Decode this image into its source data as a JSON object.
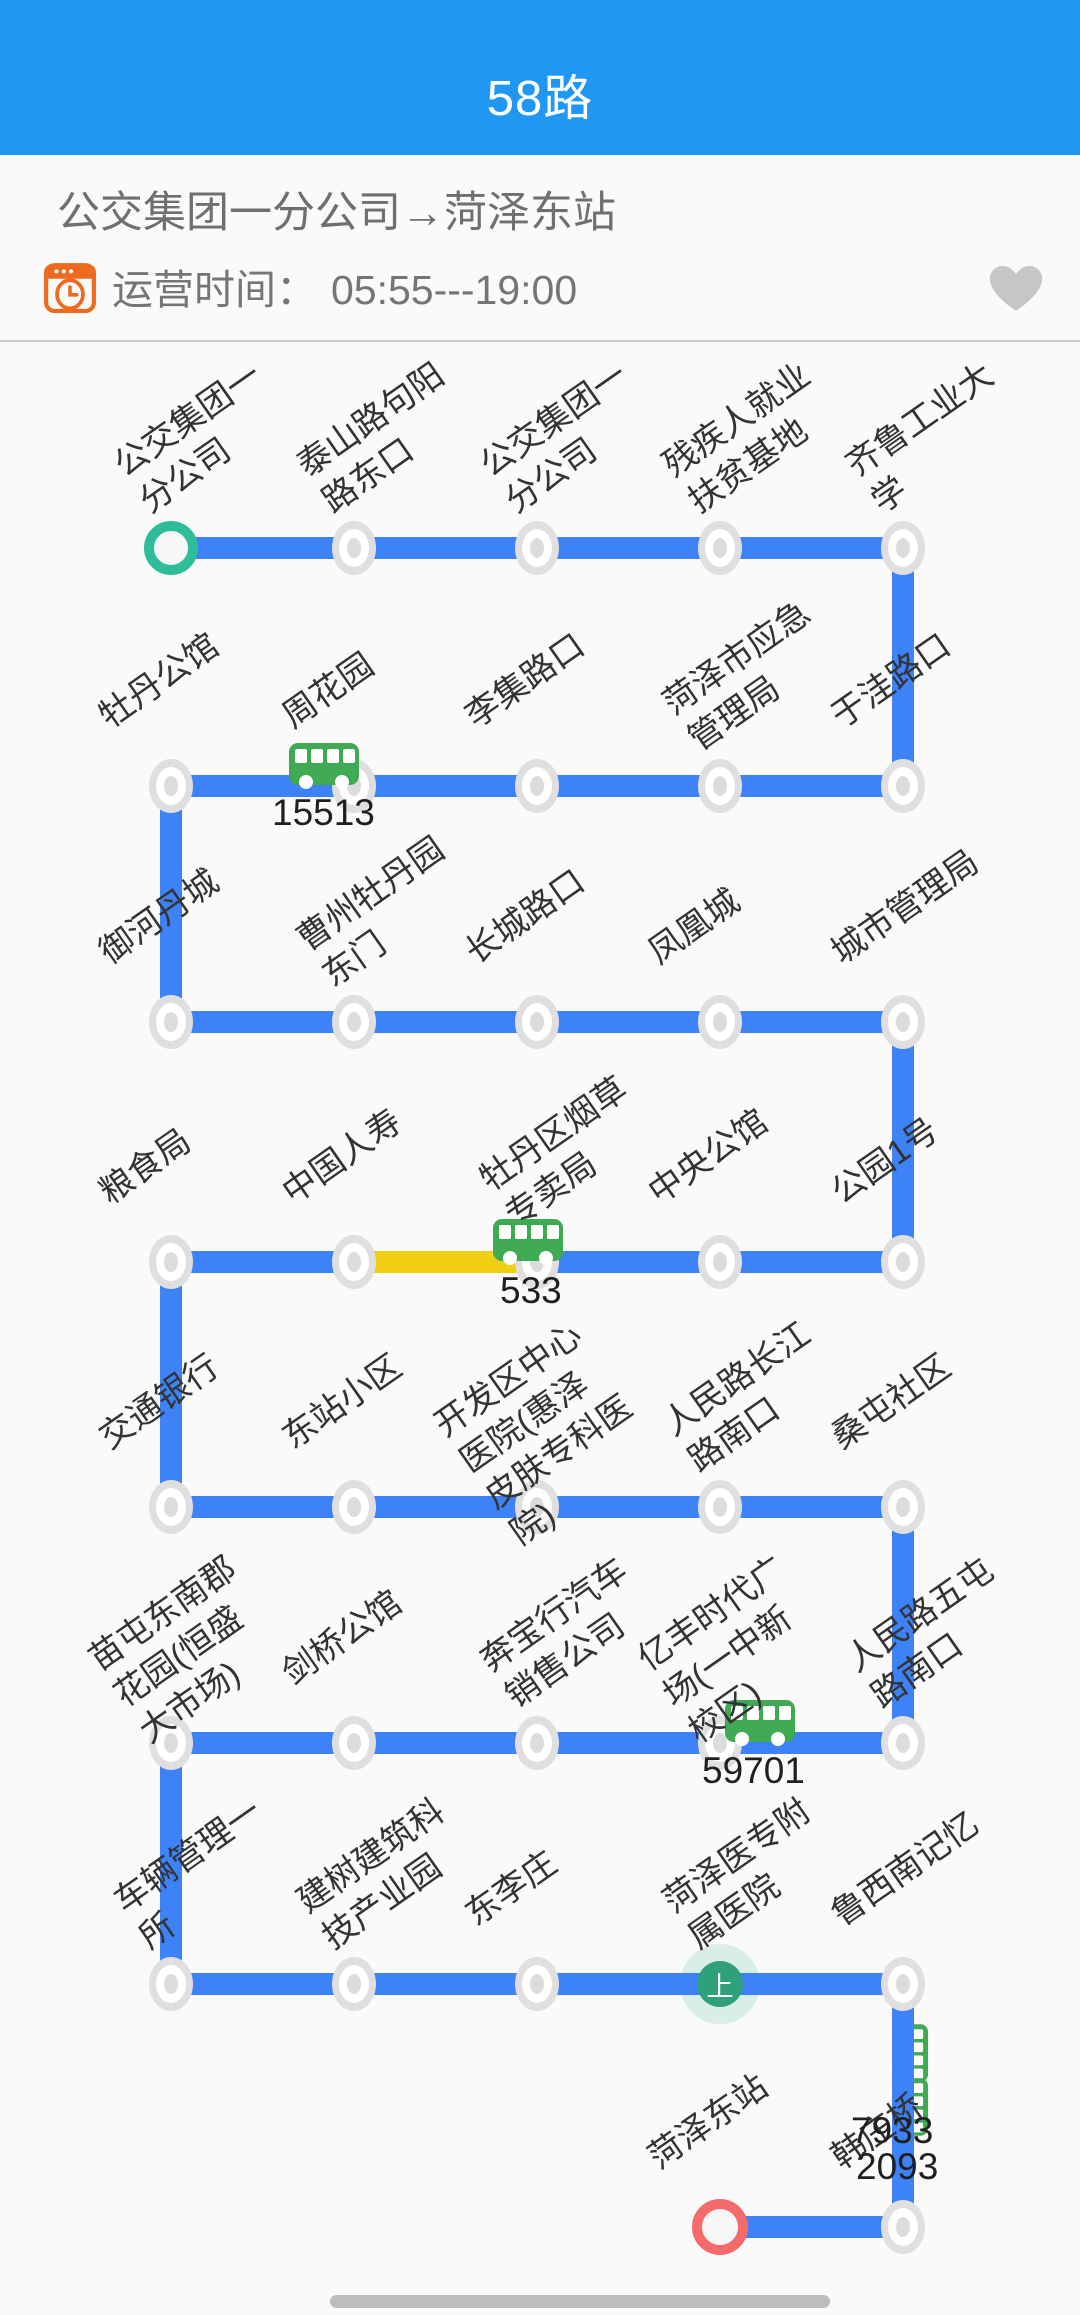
{
  "header": {
    "title": "58路"
  },
  "info": {
    "route_title": "公交集团一分公司→菏泽东站",
    "operating_time_label": "运营时间：",
    "operating_time_value": "05:55---19:00"
  },
  "colors": {
    "header_blue": "#2098F3",
    "line_blue": "#3D82F6",
    "congestion_yellow": "#F0CE12",
    "bus_green": "#3FA953",
    "start_green": "#2EBD9B",
    "end_red": "#F56B6B",
    "board_green": "#2EA07C",
    "icon_orange": "#ED6A1E",
    "heart_gray": "#C6C6C6"
  },
  "map": {
    "stations": [
      {
        "label": "公交集团一\n分公司",
        "col": 0,
        "row": 0,
        "type": "start"
      },
      {
        "label": "泰山路句阳\n路东口",
        "col": 1,
        "row": 0,
        "type": "normal"
      },
      {
        "label": "公交集团一\n分公司",
        "col": 2,
        "row": 0,
        "type": "normal"
      },
      {
        "label": "残疾人就业\n扶贫基地",
        "col": 3,
        "row": 0,
        "type": "normal"
      },
      {
        "label": "齐鲁工业大\n学",
        "col": 4,
        "row": 0,
        "type": "normal"
      },
      {
        "label": "于洼路口",
        "col": 4,
        "row": 1,
        "type": "normal"
      },
      {
        "label": "菏泽市应急\n管理局",
        "col": 3,
        "row": 1,
        "type": "normal"
      },
      {
        "label": "李集路口",
        "col": 2,
        "row": 1,
        "type": "normal"
      },
      {
        "label": "周花园",
        "col": 1,
        "row": 1,
        "type": "normal"
      },
      {
        "label": "牡丹公馆",
        "col": 0,
        "row": 1,
        "type": "normal"
      },
      {
        "label": "御河丹城",
        "col": 0,
        "row": 2,
        "type": "normal"
      },
      {
        "label": "曹州牡丹园\n东门",
        "col": 1,
        "row": 2,
        "type": "normal"
      },
      {
        "label": "长城路口",
        "col": 2,
        "row": 2,
        "type": "normal"
      },
      {
        "label": "凤凰城",
        "col": 3,
        "row": 2,
        "type": "normal"
      },
      {
        "label": "城市管理局",
        "col": 4,
        "row": 2,
        "type": "normal"
      },
      {
        "label": "公园1号",
        "col": 4,
        "row": 3,
        "type": "normal"
      },
      {
        "label": "中央公馆",
        "col": 3,
        "row": 3,
        "type": "normal"
      },
      {
        "label": "牡丹区烟草\n专卖局",
        "col": 2,
        "row": 3,
        "type": "normal"
      },
      {
        "label": "中国人寿",
        "col": 1,
        "row": 3,
        "type": "normal"
      },
      {
        "label": "粮食局",
        "col": 0,
        "row": 3,
        "type": "normal"
      },
      {
        "label": "交通银行",
        "col": 0,
        "row": 4,
        "type": "normal"
      },
      {
        "label": "东站小区",
        "col": 1,
        "row": 4,
        "type": "normal"
      },
      {
        "label": "开发区中心\n医院(惠泽\n皮肤专科医\n院)",
        "col": 2,
        "row": 4,
        "type": "normal"
      },
      {
        "label": "人民路长江\n路南口",
        "col": 3,
        "row": 4,
        "type": "normal"
      },
      {
        "label": "桑屯社区",
        "col": 4,
        "row": 4,
        "type": "normal"
      },
      {
        "label": "人民路五屯\n路南口",
        "col": 4,
        "row": 5,
        "type": "normal"
      },
      {
        "label": "亿丰时代广\n场(一中新\n校区)",
        "col": 3,
        "row": 5,
        "type": "normal"
      },
      {
        "label": "奔宝行汽车\n销售公司",
        "col": 2,
        "row": 5,
        "type": "normal"
      },
      {
        "label": "剑桥公馆",
        "col": 1,
        "row": 5,
        "type": "normal"
      },
      {
        "label": "苗屯东南郡\n花园(恒盛\n大市场)",
        "col": 0,
        "row": 5,
        "type": "normal"
      },
      {
        "label": "车辆管理一\n所",
        "col": 0,
        "row": 6,
        "type": "normal"
      },
      {
        "label": "建树建筑科\n技产业园",
        "col": 1,
        "row": 6,
        "type": "normal"
      },
      {
        "label": "东李庄",
        "col": 2,
        "row": 6,
        "type": "normal"
      },
      {
        "label": "菏泽医专附\n属医院",
        "col": 3,
        "row": 6,
        "type": "board"
      },
      {
        "label": "鲁西南记忆",
        "col": 4,
        "row": 6,
        "type": "normal"
      },
      {
        "label": "韩庄桥",
        "col": 4,
        "row": 7,
        "type": "normal"
      },
      {
        "label": "菏泽东站",
        "col": 3,
        "row": 7,
        "type": "end"
      }
    ],
    "board_marker_text": "上",
    "buses": [
      {
        "plate": "15513",
        "orient": "h",
        "x": 288,
        "y": 738,
        "label_x": 272,
        "label_y": 792
      },
      {
        "plate": "533",
        "orient": "h",
        "x": 492,
        "y": 1214,
        "label_x": 500,
        "label_y": 1270
      },
      {
        "plate": "59701",
        "orient": "h",
        "x": 724,
        "y": 1695,
        "label_x": 702,
        "label_y": 1750
      },
      {
        "plate": "7933",
        "orient": "v",
        "x": 874,
        "y": 2026,
        "label_x": 851,
        "label_y": 2110
      },
      {
        "plate": "2093",
        "orient": "v",
        "x": 874,
        "y": 2080,
        "label_x": 856,
        "label_y": 2146
      }
    ],
    "congestion": {
      "row": 3,
      "from_col": 1,
      "to_col": 2
    }
  }
}
